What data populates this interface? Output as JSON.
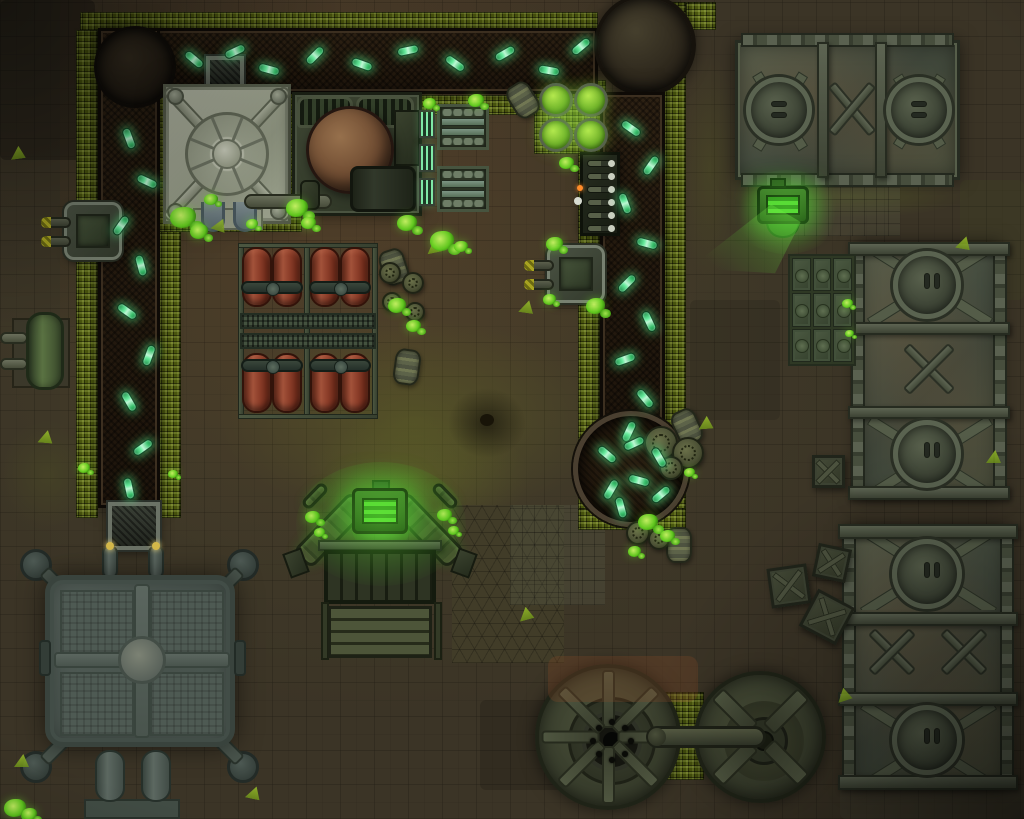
{
  "canvas": {
    "width": 1024,
    "height": 819
  },
  "palette": {
    "floor": "#3b3426",
    "rust": "#6a4226",
    "walkway": "#4e5a10",
    "belt": "#231a10",
    "vial_green": "#66eb9c",
    "goo_green": "#63cf1f",
    "vat_green": "#8cc93c",
    "steel": "#4c5440",
    "press_grey": "#a8ac9a",
    "copper": "#7c5a3e",
    "tank_red": "#8a3c28",
    "glow_green": "#46e03c"
  },
  "objects": {
    "vials": {
      "horizontal": [
        [
          183,
          55,
          40
        ],
        [
          224,
          47,
          -25
        ],
        [
          258,
          65,
          15
        ],
        [
          304,
          51,
          -45
        ],
        [
          351,
          60,
          20
        ],
        [
          397,
          46,
          -12
        ],
        [
          444,
          59,
          35
        ],
        [
          494,
          49,
          -30
        ],
        [
          538,
          66,
          10
        ],
        [
          570,
          42,
          -40
        ]
      ],
      "left": [
        [
          118,
          134,
          70
        ],
        [
          136,
          177,
          25
        ],
        [
          110,
          221,
          -55
        ],
        [
          130,
          261,
          75
        ],
        [
          116,
          307,
          35
        ],
        [
          138,
          351,
          -70
        ],
        [
          118,
          397,
          60
        ],
        [
          132,
          443,
          -35
        ],
        [
          118,
          484,
          78
        ]
      ],
      "right": [
        [
          620,
          124,
          35
        ],
        [
          640,
          161,
          -55
        ],
        [
          614,
          199,
          70
        ],
        [
          636,
          239,
          15
        ],
        [
          616,
          279,
          -45
        ],
        [
          638,
          317,
          65
        ],
        [
          614,
          355,
          -20
        ],
        [
          634,
          394,
          50
        ],
        [
          618,
          427,
          -65
        ]
      ],
      "pool": [
        [
          596,
          450,
          40
        ],
        [
          623,
          439,
          -25
        ],
        [
          648,
          453,
          60
        ],
        [
          600,
          485,
          -60
        ],
        [
          628,
          476,
          15
        ],
        [
          650,
          490,
          -40
        ],
        [
          610,
          503,
          75
        ]
      ]
    },
    "goo_splats": [
      [
        170,
        207,
        26
      ],
      [
        190,
        224,
        18
      ],
      [
        286,
        199,
        22
      ],
      [
        301,
        217,
        15
      ],
      [
        397,
        215,
        20
      ],
      [
        430,
        231,
        24
      ],
      [
        454,
        241,
        14
      ],
      [
        468,
        94,
        16
      ],
      [
        423,
        98,
        13
      ],
      [
        388,
        298,
        18
      ],
      [
        406,
        320,
        15
      ],
      [
        559,
        157,
        15
      ],
      [
        546,
        237,
        17
      ],
      [
        586,
        298,
        19
      ],
      [
        543,
        294,
        13
      ],
      [
        638,
        514,
        20
      ],
      [
        660,
        530,
        15
      ],
      [
        628,
        546,
        13
      ],
      [
        305,
        511,
        15
      ],
      [
        314,
        528,
        11
      ],
      [
        437,
        509,
        15
      ],
      [
        448,
        526,
        11
      ],
      [
        4,
        799,
        22
      ],
      [
        22,
        808,
        15
      ],
      [
        842,
        299,
        11
      ],
      [
        845,
        330,
        9
      ],
      [
        684,
        468,
        11
      ],
      [
        204,
        194,
        14
      ],
      [
        246,
        219,
        12
      ],
      [
        78,
        463,
        12
      ],
      [
        168,
        470,
        10
      ]
    ],
    "hazard_triangles": [
      [
        10,
        146,
        -8
      ],
      [
        38,
        430,
        5
      ],
      [
        212,
        218,
        18
      ],
      [
        426,
        240,
        -12
      ],
      [
        519,
        300,
        8
      ],
      [
        518,
        607,
        -15
      ],
      [
        14,
        754,
        0
      ],
      [
        246,
        786,
        12
      ],
      [
        698,
        416,
        -5
      ],
      [
        956,
        236,
        10
      ],
      [
        986,
        450,
        0
      ],
      [
        836,
        688,
        -18
      ]
    ],
    "chem_vats": [
      [
        539,
        83
      ],
      [
        574,
        83
      ],
      [
        539,
        118
      ],
      [
        574,
        118
      ]
    ],
    "radiator_panels": [
      [
        419,
        110
      ],
      [
        419,
        144
      ],
      [
        419,
        178
      ]
    ],
    "stripe_barrels": [
      [
        510,
        82,
        -32
      ],
      [
        674,
        409,
        -25
      ],
      [
        381,
        249,
        -18
      ],
      [
        394,
        349,
        8
      ],
      [
        666,
        527,
        0
      ]
    ],
    "lid_barrels": [
      [
        661,
        443,
        17
      ],
      [
        688,
        453,
        16
      ],
      [
        671,
        468,
        12
      ],
      [
        638,
        533,
        12
      ],
      [
        659,
        539,
        11
      ],
      [
        390,
        273,
        11
      ],
      [
        413,
        283,
        11
      ],
      [
        392,
        302,
        10
      ],
      [
        415,
        312,
        10
      ]
    ],
    "crates": [
      [
        812,
        455,
        0,
        33
      ],
      [
        815,
        546,
        12,
        34
      ],
      [
        769,
        566,
        -8,
        40
      ],
      [
        806,
        596,
        28,
        42
      ]
    ]
  },
  "counts": {
    "press_ring_spokes": 8,
    "turbine_left_ribs": 8,
    "turbine_left_bolts": 8,
    "turbine_right_arms": 4,
    "console_levers": 6,
    "floor_plate_cols": 3,
    "floor_plate_rows": 3
  }
}
